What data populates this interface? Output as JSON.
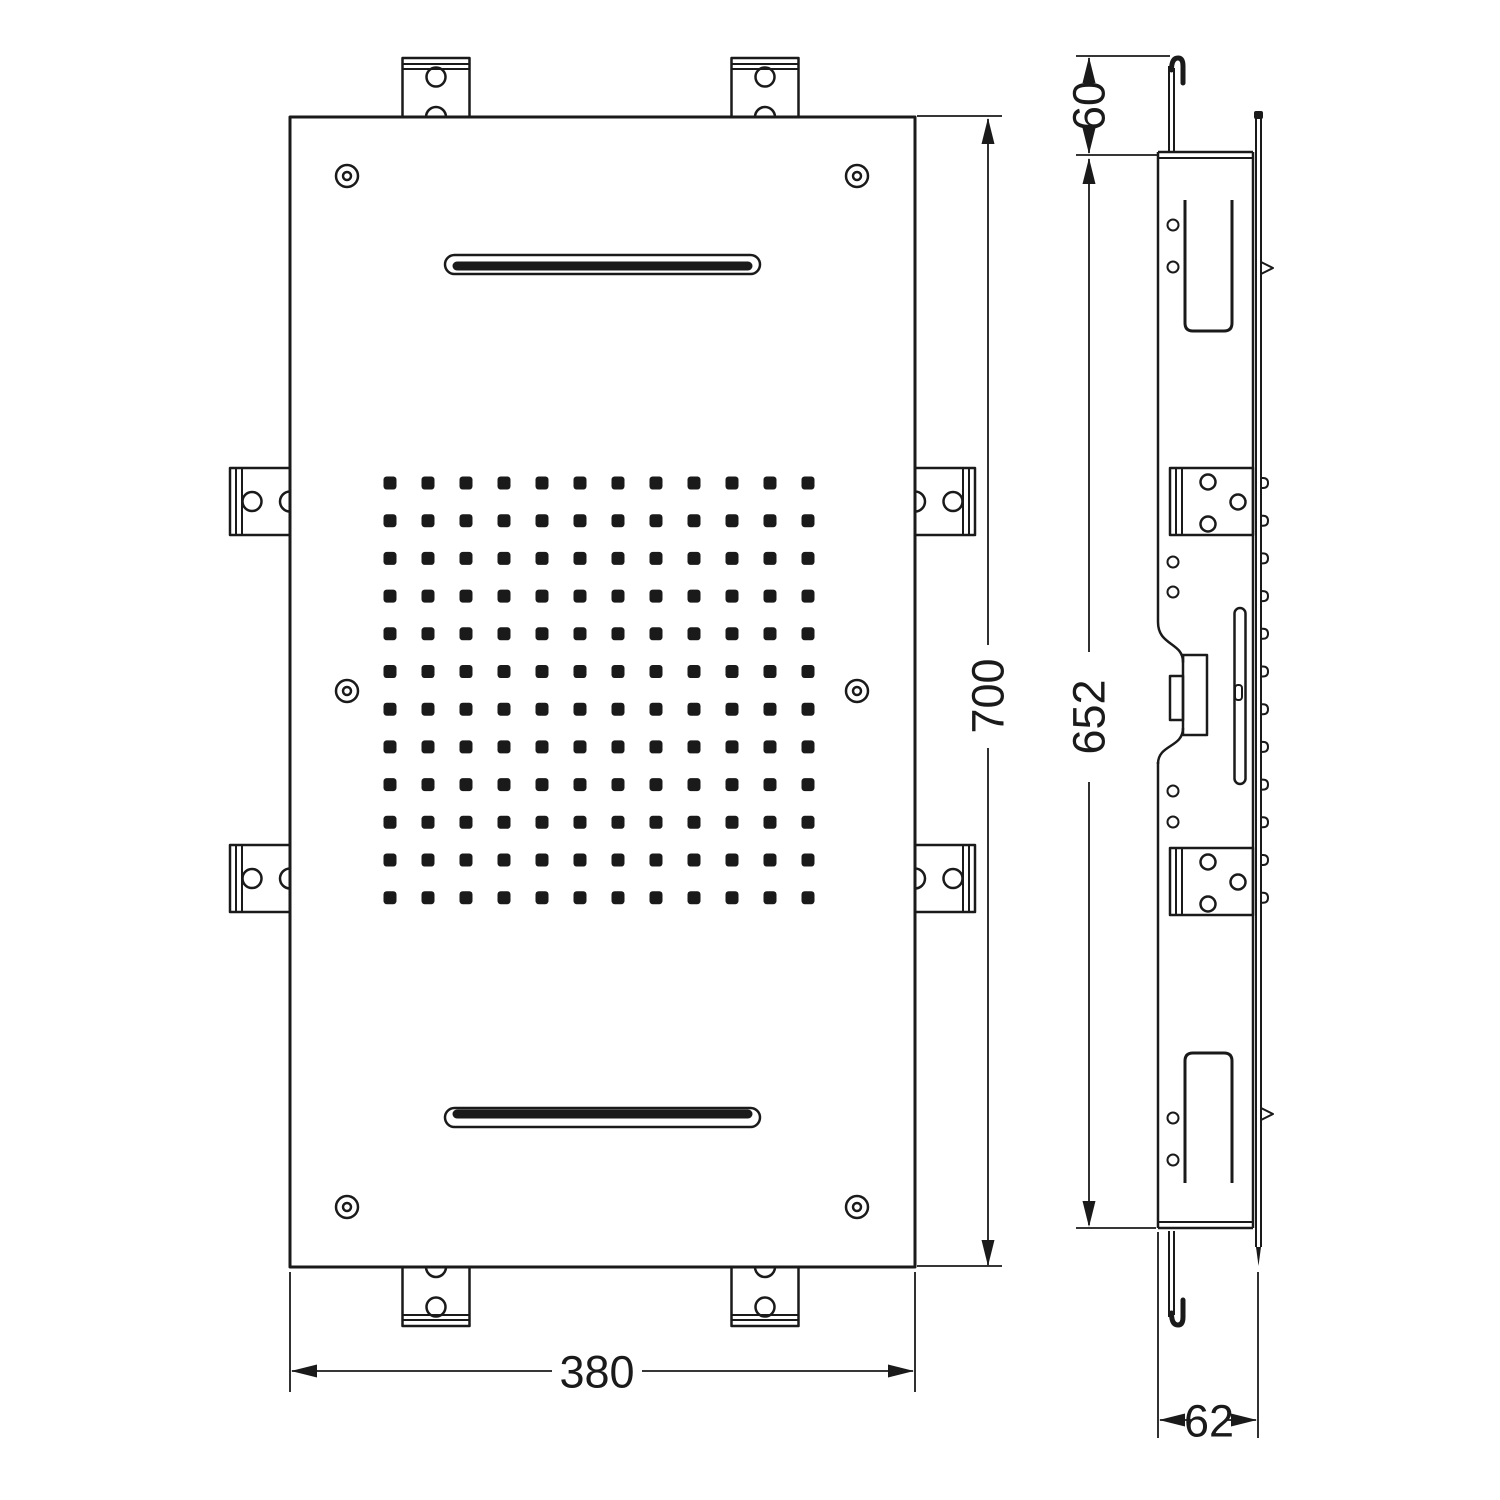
{
  "page": {
    "background": "#ffffff",
    "line_color": "#1a1a1a",
    "description_labels": []
  },
  "front_view": {
    "dim_height_label": "700",
    "dim_width_label": "380",
    "panel": {
      "x": 290,
      "y": 117,
      "w": 625,
      "h": 1150
    },
    "nozzle_grid": {
      "cols": 12,
      "rows": 12,
      "x_start": 390,
      "x_step": 38,
      "y_start": 483,
      "y_step": 37.7,
      "size": 13
    },
    "screw_holes": [
      [
        347,
        176
      ],
      [
        857,
        176
      ],
      [
        347,
        691
      ],
      [
        857,
        691
      ],
      [
        347,
        1207
      ],
      [
        857,
        1207
      ]
    ],
    "slots": {
      "x1": 445,
      "x2": 760,
      "top_y": 255,
      "bottom_y": 1108,
      "h": 19
    },
    "top_tab_centers_x": [
      436,
      765
    ],
    "side_tab_centers_y": [
      501.5,
      878.5
    ]
  },
  "side_view": {
    "dim_hook_label": "60",
    "dim_body_label": "652",
    "dim_depth_label": "62",
    "body": {
      "x": 1158,
      "y": 155,
      "w": 95,
      "h": 1073
    },
    "bracket_ys": [
      468,
      848
    ],
    "pin_hole_x": 1173,
    "pin_hole_ys": [
      225,
      267,
      562,
      592,
      791,
      822,
      1118,
      1160
    ],
    "nozzle_bump_x": 1261,
    "spout_tip_ys": [
      262,
      1108
    ]
  }
}
